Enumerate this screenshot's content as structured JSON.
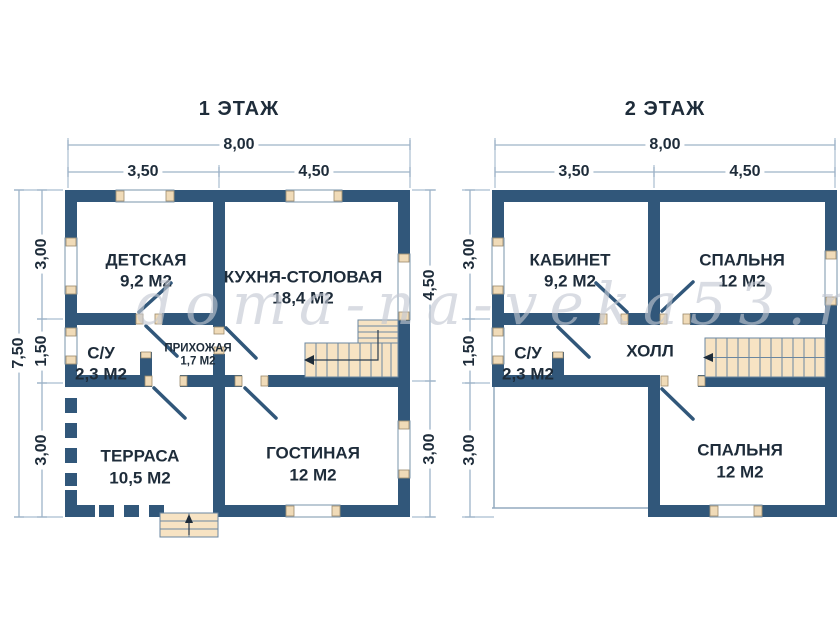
{
  "watermark": "doma-na-veka53.ru",
  "colors": {
    "wall": "#31577a",
    "stairs_fill": "#f7e3c3",
    "dim_line": "#9db3c8",
    "label_text": "#1e2c3a",
    "watermark_text": "#c3c8d2"
  },
  "floor1": {
    "title": "1 ЭТАЖ",
    "rooms": {
      "detskaya": {
        "name": "ДЕТСКАЯ",
        "area": "9,2 М2"
      },
      "kitchen": {
        "name": "КУХНЯ-СТОЛОВАЯ",
        "area": "18,4 М2"
      },
      "su": {
        "name": "С/У",
        "area": "2,3 М2"
      },
      "hallway": {
        "name": "ПРИХОЖАЯ",
        "area": "1,7 М2"
      },
      "terrace": {
        "name": "ТЕРРАСА",
        "area": "10,5 М2"
      },
      "living": {
        "name": "ГОСТИНАЯ",
        "area": "12 М2"
      }
    },
    "dims": {
      "total_width": "8,00",
      "width_left": "3,50",
      "width_right": "4,50",
      "total_height": "7,50",
      "h_seg1": "3,00",
      "h_seg2": "1,50",
      "h_seg3": "3,00",
      "right_seg1": "4,50",
      "right_seg2": "3,00"
    }
  },
  "floor2": {
    "title": "2 ЭТАЖ",
    "rooms": {
      "office": {
        "name": "КАБИНЕТ",
        "area": "9,2 М2"
      },
      "bedroom1": {
        "name": "СПАЛЬНЯ",
        "area": "12 М2"
      },
      "su": {
        "name": "С/У",
        "area": "2,3 М2"
      },
      "hall": {
        "name": "ХОЛЛ"
      },
      "bedroom2": {
        "name": "СПАЛЬНЯ",
        "area": "12 М2"
      }
    },
    "dims": {
      "total_width": "8,00",
      "width_left": "3,50",
      "width_right": "4,50",
      "h_seg1": "3,00",
      "h_seg2": "1,50",
      "h_seg3": "3,00"
    }
  }
}
